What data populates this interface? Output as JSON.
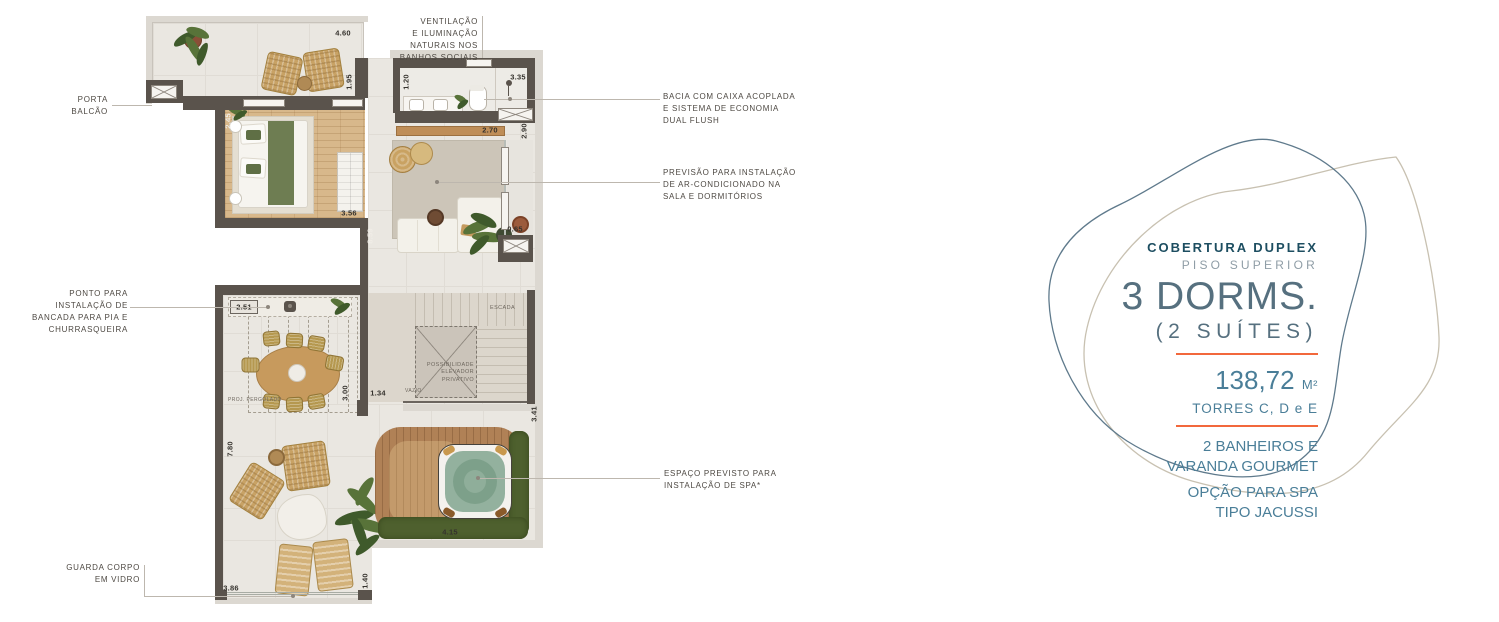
{
  "callouts": {
    "ventilacao": "VENTILAÇÃO\nE ILUMINAÇÃO\nNATURAIS NOS\nBANHOS SOCIAIS",
    "porta_balcao": "PORTA\nBALCÃO",
    "bacia": "BACIA COM CAIXA ACOPLADA\nE SISTEMA DE ECONOMIA\nDUAL FLUSH",
    "ar_condicionado": "PREVISÃO PARA INSTALAÇÃO\nDE AR-CONDICIONADO NA\nSALA E DORMITÓRIOS",
    "bancada": "PONTO PARA\nINSTALAÇÃO DE\nBANCADA PARA PIA E\nCHURRASQUEIRA",
    "spa": "ESPAÇO PREVISTO PARA\nINSTALAÇÃO DE SPA*",
    "guarda_corpo": "GUARDA CORPO\nEM VIDRO"
  },
  "room_labels": {
    "escada": "ESCADA",
    "elevador": "POSSIBILIDADE\nELEVADOR\nPRIVATIVO",
    "vazio": "VAZIO",
    "pergolado": "PROJ. PERGOLADO"
  },
  "dims": {
    "terrace_top": "4.60",
    "terrace_right": "1.95",
    "bedroom_left": "2.45",
    "bath_left": "1.20",
    "bath_top": "3.35",
    "bath_bottom": "2.70",
    "bath_right": "2.90",
    "bedroom_bottom": "3.56",
    "living_left": "8.59",
    "living_right": "0.65",
    "bancada": "2.51",
    "pergola_right": "3.00",
    "passage": "1.34",
    "terrace_left": "7.80",
    "spa_right": "3.41",
    "spa_bottom": "4.15",
    "bottom_right": "1.40",
    "bottom_left": "3.86"
  },
  "info_panel": {
    "kicker": "COBERTURA DUPLEX",
    "floor": "PISO SUPERIOR",
    "headline": "3 DORMS.",
    "subheadline": "(2 SUÍTES)",
    "area_value": "138,72",
    "area_unit": "M²",
    "towers": "TORRES C, D e E",
    "feature_1": "2 BANHEIROS E\nVARANDA GOURMET",
    "feature_2": "OPÇÃO PARA SPA\nTIPO JACUSSI"
  },
  "colors": {
    "accent": "#f2683c",
    "heading": "#1d4e61",
    "muted": "#8f9da6",
    "headline": "#56707f",
    "body": "#4a7e98",
    "wall": "#5a534c",
    "blob_dark": "#5f7a8c",
    "blob_tan": "#c8c1b1"
  }
}
